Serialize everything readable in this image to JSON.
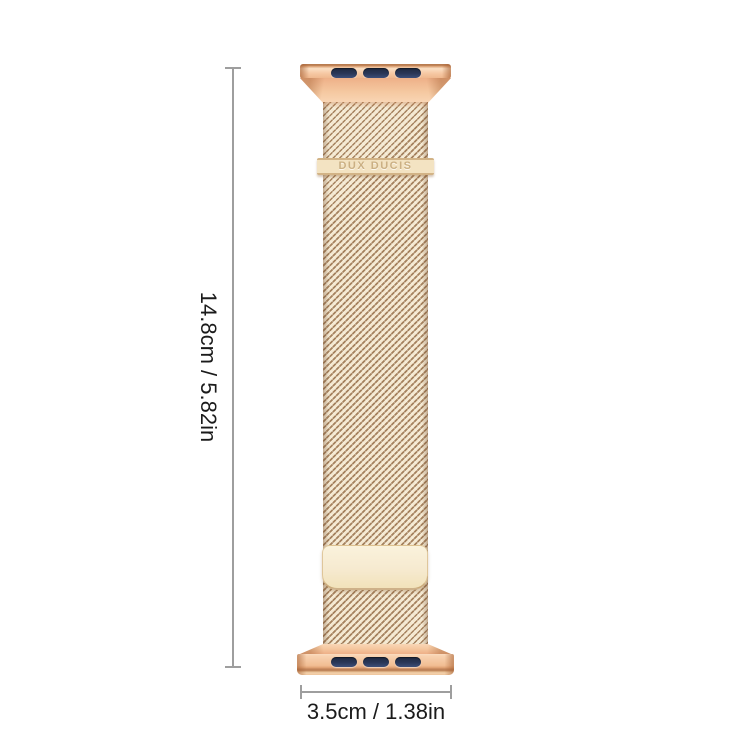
{
  "product": {
    "name": "Milanese loop watch band",
    "finish": "champagne rose gold",
    "brand_label": "DUX DUCIS"
  },
  "annotations": {
    "height_label": "14.8cm / 5.82in",
    "width_label": "3.5cm / 1.38in"
  },
  "theme": {
    "bg": "#ffffff",
    "rose-gold": "#f6c8a4",
    "rose-gold-light": "#fbe0c4",
    "rose-edge": "#b87c50",
    "mesh-cream": "#f4e8d0",
    "mesh-tan": "#a5815d",
    "keeper-bg": "#f3e3c2",
    "keeper-edge": "#d2b386",
    "keeper-text": "#cbb083",
    "clasp-bg-top": "#faf2dc",
    "clasp-bg-bottom": "#f2e2ba",
    "slot-navy": "#2a3757",
    "slot-navy-dark": "#1e2940",
    "dim-line": "#9e9e9e",
    "dim-text": "#1b1b1b"
  }
}
